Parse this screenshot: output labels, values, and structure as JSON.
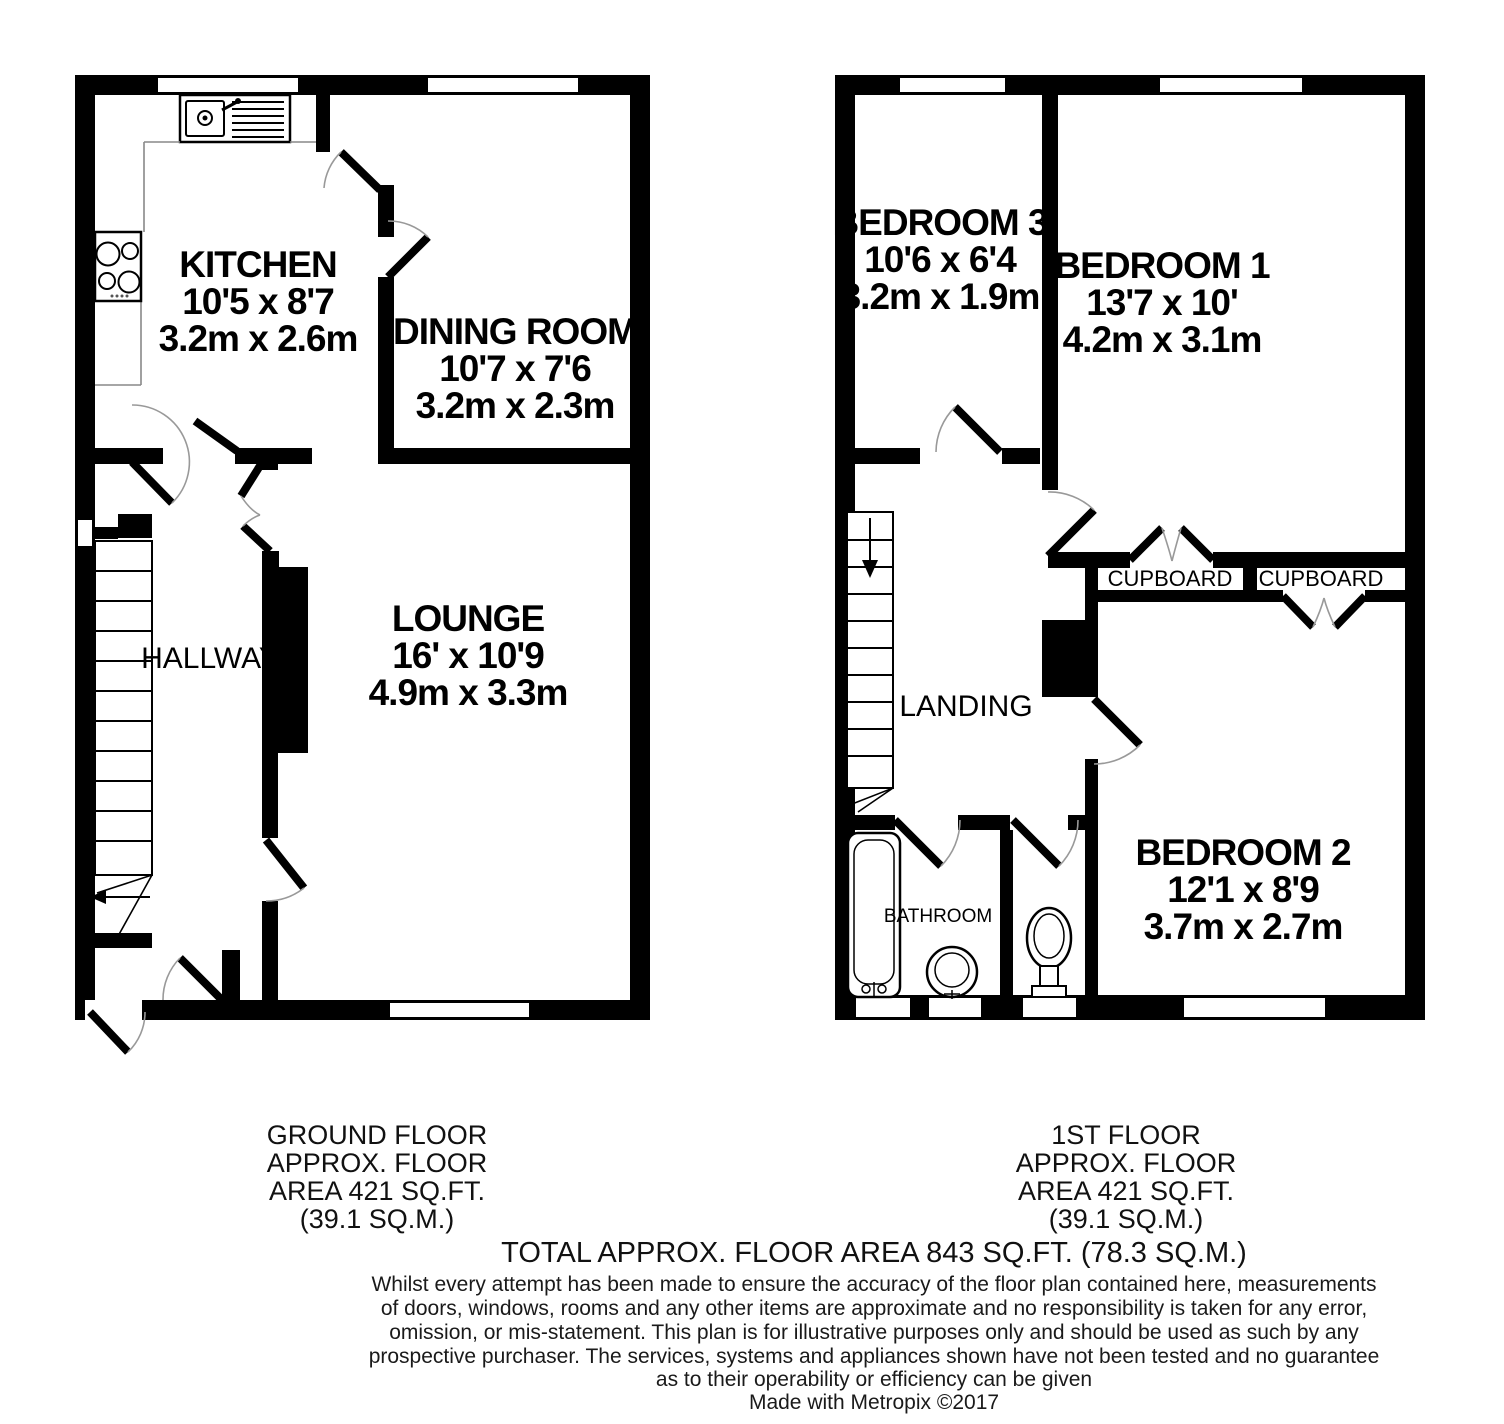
{
  "ground_floor": {
    "rooms": {
      "kitchen": {
        "name": "KITCHEN",
        "size_imperial": "10'5 x 8'7",
        "size_metric": "3.2m x 2.6m"
      },
      "dining_room": {
        "name": "DINING ROOM",
        "size_imperial": "10'7 x 7'6",
        "size_metric": "3.2m x 2.3m"
      },
      "lounge": {
        "name": "LOUNGE",
        "size_imperial": "16' x 10'9",
        "size_metric": "4.9m x 3.3m"
      },
      "hallway": {
        "name": "HALLWAY"
      }
    },
    "summary_lines": [
      "GROUND FLOOR",
      "APPROX. FLOOR",
      "AREA 421 SQ.FT.",
      "(39.1 SQ.M.)"
    ]
  },
  "first_floor": {
    "rooms": {
      "bedroom_1": {
        "name": "BEDROOM 1",
        "size_imperial": "13'7 x 10'",
        "size_metric": "4.2m x 3.1m"
      },
      "bedroom_2": {
        "name": "BEDROOM 2",
        "size_imperial": "12'1 x 8'9",
        "size_metric": "3.7m x 2.7m"
      },
      "bedroom_3": {
        "name": "BEDROOM 3",
        "size_imperial": "10'6 x 6'4",
        "size_metric": "3.2m x 1.9m"
      },
      "landing": {
        "name": "LANDING"
      },
      "bathroom": {
        "name": "BATHROOM"
      },
      "cupboard_1": {
        "name": "CUPBOARD"
      },
      "cupboard_2": {
        "name": "CUPBOARD"
      }
    },
    "summary_lines": [
      "1ST FLOOR",
      "APPROX. FLOOR",
      "AREA 421 SQ.FT.",
      "(39.1 SQ.M.)"
    ]
  },
  "footer": {
    "total_area": "TOTAL APPROX. FLOOR AREA 843 SQ.FT. (78.3 SQ.M.)",
    "disclaimer_lines": [
      "Whilst every attempt has been made to ensure the accuracy of the floor plan contained here, measurements",
      "of doors, windows, rooms and any other items are approximate and no responsibility is taken for any error,",
      "omission, or mis-statement. This plan is for illustrative purposes only and should be used as such by any",
      "prospective purchaser. The services, systems and appliances shown have not been tested and no guarantee",
      "as to their operability or efficiency can be given"
    ],
    "credit": "Made with Metropix ©2017"
  },
  "colors": {
    "walls": "#000000",
    "background": "#ffffff",
    "door_swing": "#999999",
    "counter_line": "#888888"
  }
}
